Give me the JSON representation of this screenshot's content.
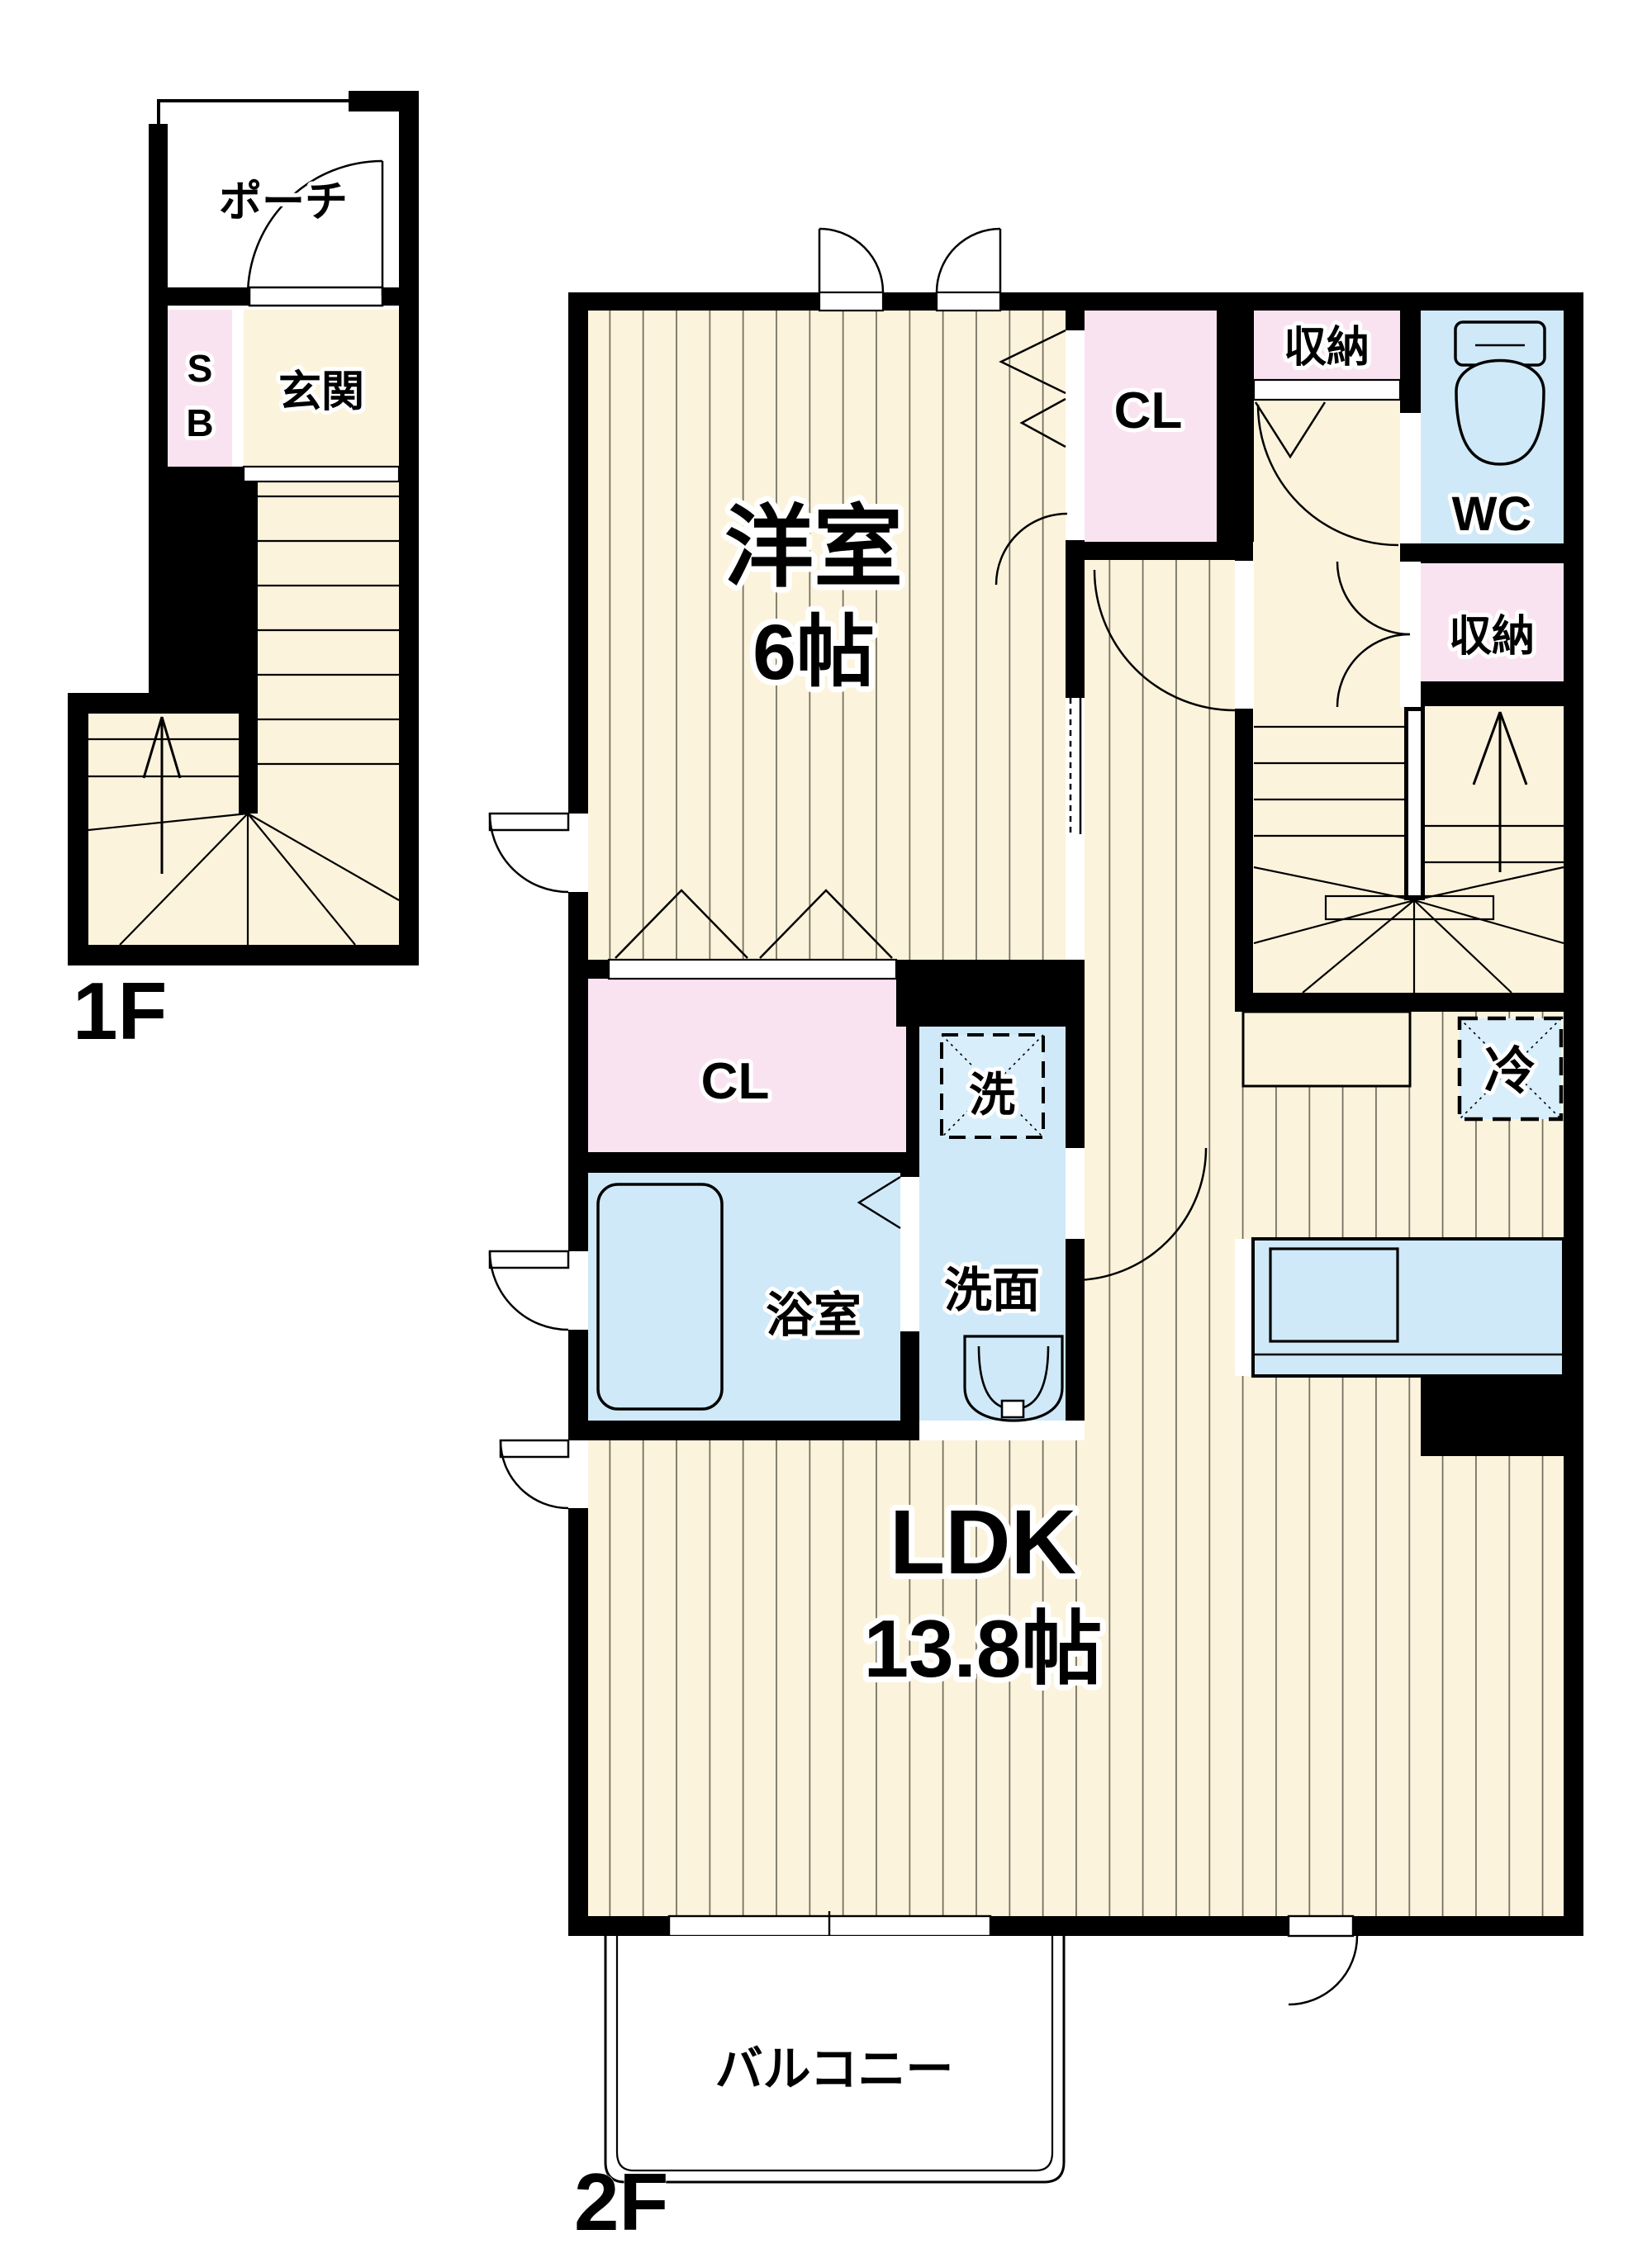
{
  "document": {
    "type": "floor-plan",
    "floors": {
      "f1_label": "1F",
      "f2_label": "2F"
    }
  },
  "rooms": {
    "porch": "ポーチ",
    "shoebox_line1": "S",
    "shoebox_line2": "B",
    "entrance": "玄関",
    "western_room_name": "洋室",
    "western_room_size": "6帖",
    "closet_upper": "CL",
    "closet_mid": "CL",
    "storage_top": "収納",
    "storage_right": "収納",
    "wc": "WC",
    "refrigerator": "冷",
    "washing_machine": "洗",
    "washroom": "洗面",
    "bathroom": "浴室",
    "ldk_name": "LDK",
    "ldk_size": "13.8帖",
    "balcony": "バルコニー"
  },
  "colors": {
    "wall": "#000000",
    "floor_cream": "#fcf3dc",
    "floor_line": "#6e6a5a",
    "closet_pink": "#fae3f1",
    "wet_area_blue": "#cfe9f8",
    "equipment_blue": "#d8eefb",
    "background": "#ffffff"
  }
}
